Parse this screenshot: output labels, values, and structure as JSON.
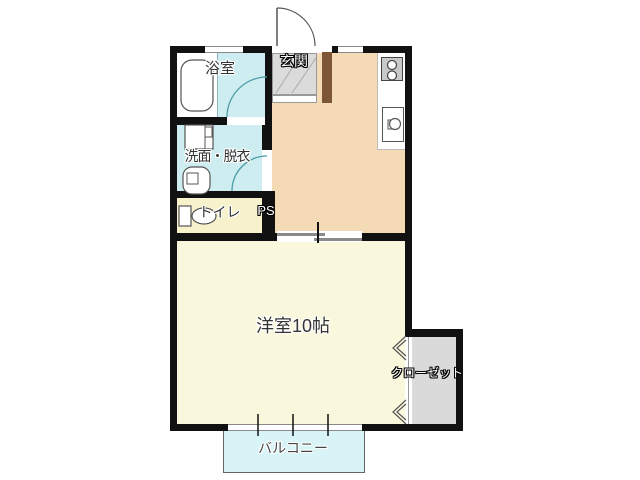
{
  "floorplan": {
    "rooms": {
      "bathroom": {
        "label": "浴室"
      },
      "entrance": {
        "label": "玄関"
      },
      "washroom": {
        "label": "洗面・脱衣"
      },
      "toilet": {
        "label": "トイレ"
      },
      "pipe_space": {
        "label": "PS"
      },
      "main_room": {
        "label": "洋室10帖"
      },
      "closet": {
        "label": "クローゼット"
      },
      "balcony": {
        "label": "バルコニー"
      }
    },
    "colors": {
      "wall": "#111111",
      "dk_floor": "#F5DBB5",
      "main_room_floor": "#FAF8DC",
      "toilet_floor": "#F7F1CC",
      "wet_area_floor": "#CDEDF1",
      "balcony_floor": "#D8F4F7",
      "closet_floor": "#DADADA",
      "entrance_tile": "#DBDBDB",
      "entrance_step_wood": "#7D5637",
      "door_swing_arc": "#4D9CA6"
    }
  }
}
